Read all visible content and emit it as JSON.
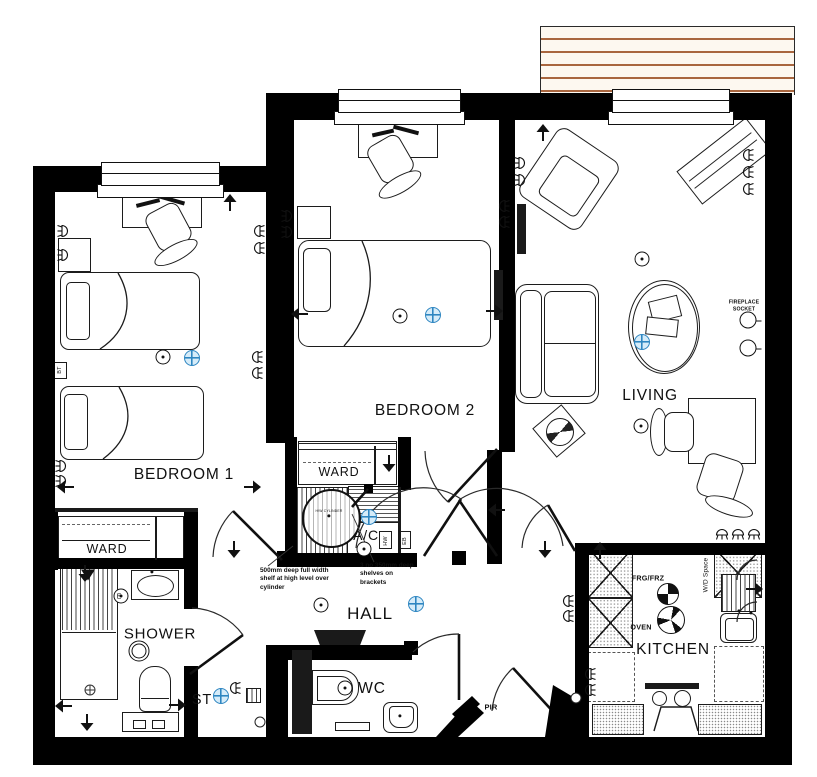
{
  "colors": {
    "wall": "#000000",
    "line": "#1c1c1c",
    "detector_blue": "#2e86c1",
    "detector_fill": "#d6ecf9",
    "deck_line": "#a9663f",
    "deck_bg": "#fdf8f0"
  },
  "rooms": [
    {
      "id": "bedroom1",
      "label": "BEDROOM 1",
      "x": 184,
      "y": 475,
      "size": 15.5
    },
    {
      "id": "bedroom2",
      "label": "BEDROOM 2",
      "x": 425,
      "y": 411,
      "size": 15.5
    },
    {
      "id": "living",
      "label": "LIVING",
      "x": 650,
      "y": 396,
      "size": 15.5
    },
    {
      "id": "kitchen",
      "label": "KITCHEN",
      "x": 673,
      "y": 650,
      "size": 15.5
    },
    {
      "id": "hall",
      "label": "HALL",
      "x": 370,
      "y": 614,
      "size": 17
    },
    {
      "id": "shower",
      "label": "SHOWER",
      "x": 160,
      "y": 634,
      "size": 15
    },
    {
      "id": "wc",
      "label": "WC",
      "x": 372,
      "y": 689,
      "size": 15.5
    },
    {
      "id": "st",
      "label": "ST",
      "x": 202,
      "y": 700,
      "size": 14.5
    },
    {
      "id": "ac",
      "label": "A/C",
      "x": 366,
      "y": 535,
      "size": 14
    },
    {
      "id": "ward1",
      "label": "WARD",
      "x": 107,
      "y": 549,
      "size": 12.5
    },
    {
      "id": "ward2",
      "label": "WARD",
      "x": 339,
      "y": 472,
      "size": 12.5
    }
  ],
  "small_labels": [
    {
      "id": "frg-frz",
      "text": "FRG/FRZ",
      "x": 648,
      "y": 578,
      "size": 7.2,
      "rotate": 0,
      "bold": true
    },
    {
      "id": "oven",
      "text": "OVEN",
      "x": 641,
      "y": 627,
      "size": 7.2,
      "rotate": 0,
      "bold": true
    },
    {
      "id": "wd-space",
      "text": "W/D Space",
      "x": 706,
      "y": 575,
      "size": 6.5,
      "rotate": -90,
      "bold": false
    },
    {
      "id": "pir",
      "text": "PIR",
      "x": 491,
      "y": 707,
      "size": 7.5,
      "rotate": 0,
      "bold": true
    },
    {
      "id": "bt",
      "text": "BT",
      "x": 60,
      "y": 370,
      "size": 5.5,
      "rotate": -90,
      "bold": false
    },
    {
      "id": "hw",
      "text": "HW",
      "x": 386,
      "y": 541,
      "size": 5.5,
      "rotate": -90,
      "bold": false
    },
    {
      "id": "eb",
      "text": "EB",
      "x": 405,
      "y": 541,
      "size": 5.5,
      "rotate": -90,
      "bold": false
    },
    {
      "id": "e-fan",
      "text": "E",
      "x": 119,
      "y": 597,
      "size": 7,
      "rotate": 0,
      "bold": false
    },
    {
      "id": "cylinder",
      "text": "H/W CYLINDER",
      "x": 329,
      "y": 511,
      "size": 3.4,
      "rotate": 0,
      "bold": false
    }
  ],
  "fireplace_note": {
    "line1": "FIREPLACE",
    "line2": "SOCKET",
    "x": 744,
    "y": 306,
    "size": 5.2
  },
  "annotations": [
    {
      "id": "note-shelf",
      "text": "500mm deep full width shelf at high level over cylinder",
      "x": 260,
      "y": 567,
      "w": 80
    },
    {
      "id": "note-shelves",
      "text": "3 no 350mm deep shelves on brackets",
      "x": 360,
      "y": 562,
      "w": 56
    }
  ],
  "symbols": {
    "ceiling_lights": [
      [
        163,
        357
      ],
      [
        400,
        316
      ],
      [
        642,
        259
      ],
      [
        641,
        426
      ],
      [
        321,
        605
      ],
      [
        345,
        688
      ],
      [
        364,
        549
      ],
      [
        121,
        596
      ]
    ],
    "detectors": [
      [
        192,
        358
      ],
      [
        433,
        315
      ],
      [
        642,
        342
      ],
      [
        369,
        517
      ],
      [
        416,
        604
      ],
      [
        221,
        696
      ]
    ],
    "rings": [
      [
        139,
        651
      ]
    ],
    "quartered": [
      [
        668,
        594
      ]
    ],
    "fans": [
      [
        671,
        620
      ]
    ],
    "fireplace_sockets": [
      [
        748,
        320
      ],
      [
        748,
        348
      ]
    ],
    "drains": [
      [
        90,
        690
      ]
    ],
    "misc_circles": [
      [
        576,
        698
      ],
      [
        260,
        722
      ]
    ],
    "dots": [
      [
        329,
        516
      ],
      [
        739,
        611
      ],
      [
        751,
        613
      ],
      [
        152,
        572
      ],
      [
        400,
        716
      ]
    ],
    "arrows": [
      {
        "x": 230,
        "y": 203,
        "d": "up"
      },
      {
        "x": 66,
        "y": 487,
        "d": "left"
      },
      {
        "x": 252,
        "y": 487,
        "d": "right"
      },
      {
        "x": 234,
        "y": 549,
        "d": "down"
      },
      {
        "x": 300,
        "y": 314,
        "d": "left"
      },
      {
        "x": 494,
        "y": 311,
        "d": "right"
      },
      {
        "x": 543,
        "y": 133,
        "d": "up"
      },
      {
        "x": 497,
        "y": 510,
        "d": "left"
      },
      {
        "x": 545,
        "y": 549,
        "d": "down"
      },
      {
        "x": 85,
        "y": 573,
        "d": "down"
      },
      {
        "x": 64,
        "y": 706,
        "d": "left"
      },
      {
        "x": 87,
        "y": 722,
        "d": "down"
      },
      {
        "x": 177,
        "y": 705,
        "d": "right"
      },
      {
        "x": 600,
        "y": 551,
        "d": "up"
      },
      {
        "x": 754,
        "y": 589,
        "d": "right"
      },
      {
        "x": 389,
        "y": 463,
        "d": "down"
      }
    ],
    "lamps": [
      {
        "x": 64,
        "y": 231,
        "r": 0
      },
      {
        "x": 64,
        "y": 255,
        "r": 0
      },
      {
        "x": 62,
        "y": 466,
        "r": 0
      },
      {
        "x": 62,
        "y": 481,
        "r": 0
      },
      {
        "x": 258,
        "y": 231,
        "r": 180
      },
      {
        "x": 258,
        "y": 248,
        "r": 180
      },
      {
        "x": 256,
        "y": 357,
        "r": 180
      },
      {
        "x": 256,
        "y": 373,
        "r": 180
      },
      {
        "x": 288,
        "y": 216,
        "r": 0
      },
      {
        "x": 288,
        "y": 232,
        "r": 0
      },
      {
        "x": 503,
        "y": 206,
        "r": 180
      },
      {
        "x": 503,
        "y": 222,
        "r": 180
      },
      {
        "x": 521,
        "y": 163,
        "r": 0
      },
      {
        "x": 521,
        "y": 180,
        "r": 0
      },
      {
        "x": 747,
        "y": 155,
        "r": 180
      },
      {
        "x": 747,
        "y": 172,
        "r": 180
      },
      {
        "x": 747,
        "y": 189,
        "r": 180
      },
      {
        "x": 722,
        "y": 533,
        "r": 270
      },
      {
        "x": 738,
        "y": 533,
        "r": 270
      },
      {
        "x": 754,
        "y": 533,
        "r": 270
      },
      {
        "x": 567,
        "y": 601,
        "r": 180
      },
      {
        "x": 567,
        "y": 616,
        "r": 180
      },
      {
        "x": 589,
        "y": 674,
        "r": 180
      },
      {
        "x": 589,
        "y": 690,
        "r": 180
      },
      {
        "x": 234,
        "y": 688,
        "r": 180
      }
    ]
  }
}
